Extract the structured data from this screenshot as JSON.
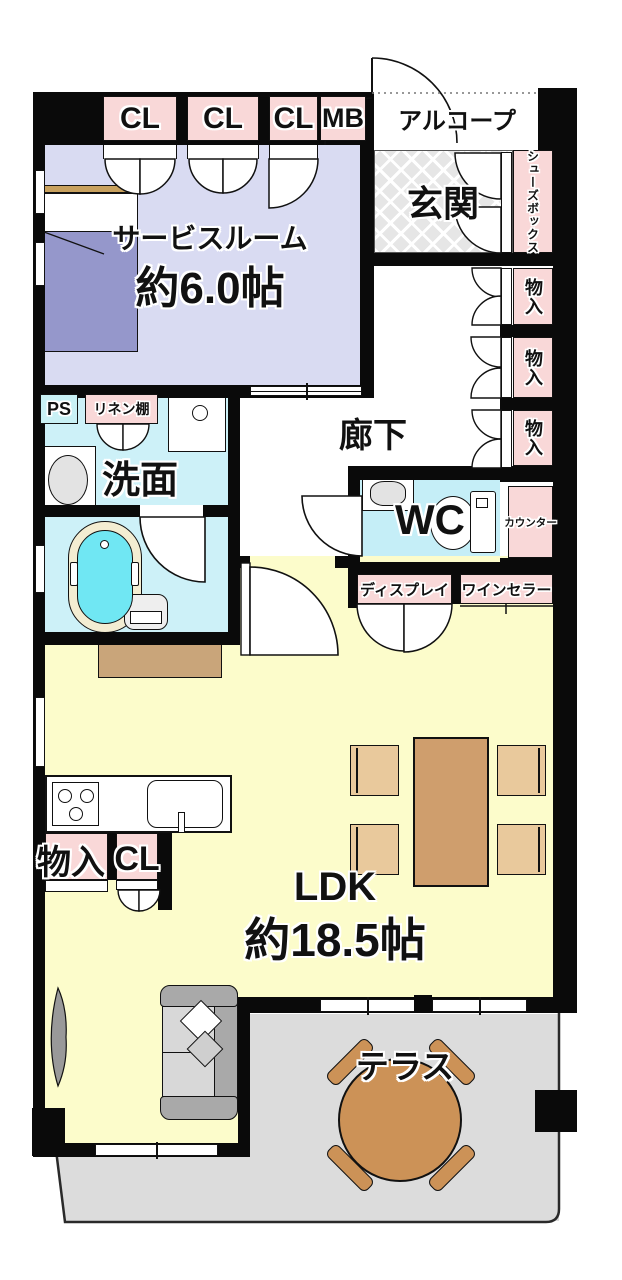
{
  "rooms": {
    "service": {
      "name": "サービスルーム",
      "size": "約6.0帖"
    },
    "entrance": "玄関",
    "alcove": "アルコープ",
    "corridor": "廊下",
    "washroom": "洗面",
    "toilet": "WC",
    "ldk": {
      "name": "LDK",
      "size": "約18.5帖"
    },
    "terrace": "テラス"
  },
  "storage": {
    "closet_1": "CL",
    "closet_2": "CL",
    "closet_3": "CL",
    "meter_box": "MB",
    "shoe_box": "シューズボックス",
    "hall_storage_1": "物入",
    "hall_storage_2": "物入",
    "hall_storage_3": "物入",
    "counter": "カウンター",
    "display": "ディスプレイ",
    "wine_cellar": "ワインセラー",
    "pipe_space": "PS",
    "linen_shelf": "リネン棚",
    "kitchen_storage": "物入",
    "kitchen_closet": "CL"
  },
  "colors": {
    "wall": "#0a0a0a",
    "service_room_floor": "#d9dbf2",
    "wet_area_floor": "#cdf1f8",
    "wc_floor": "#c5eef7",
    "ldk_floor": "#fcfccb",
    "terrace_floor": "#dcdcdc",
    "label_box_pink": "#f9d8d8",
    "bathtub": "#70e7f3",
    "bed": "#9597cb",
    "dining_table": "#cf9e6d",
    "terrace_table": "#cc9257"
  }
}
